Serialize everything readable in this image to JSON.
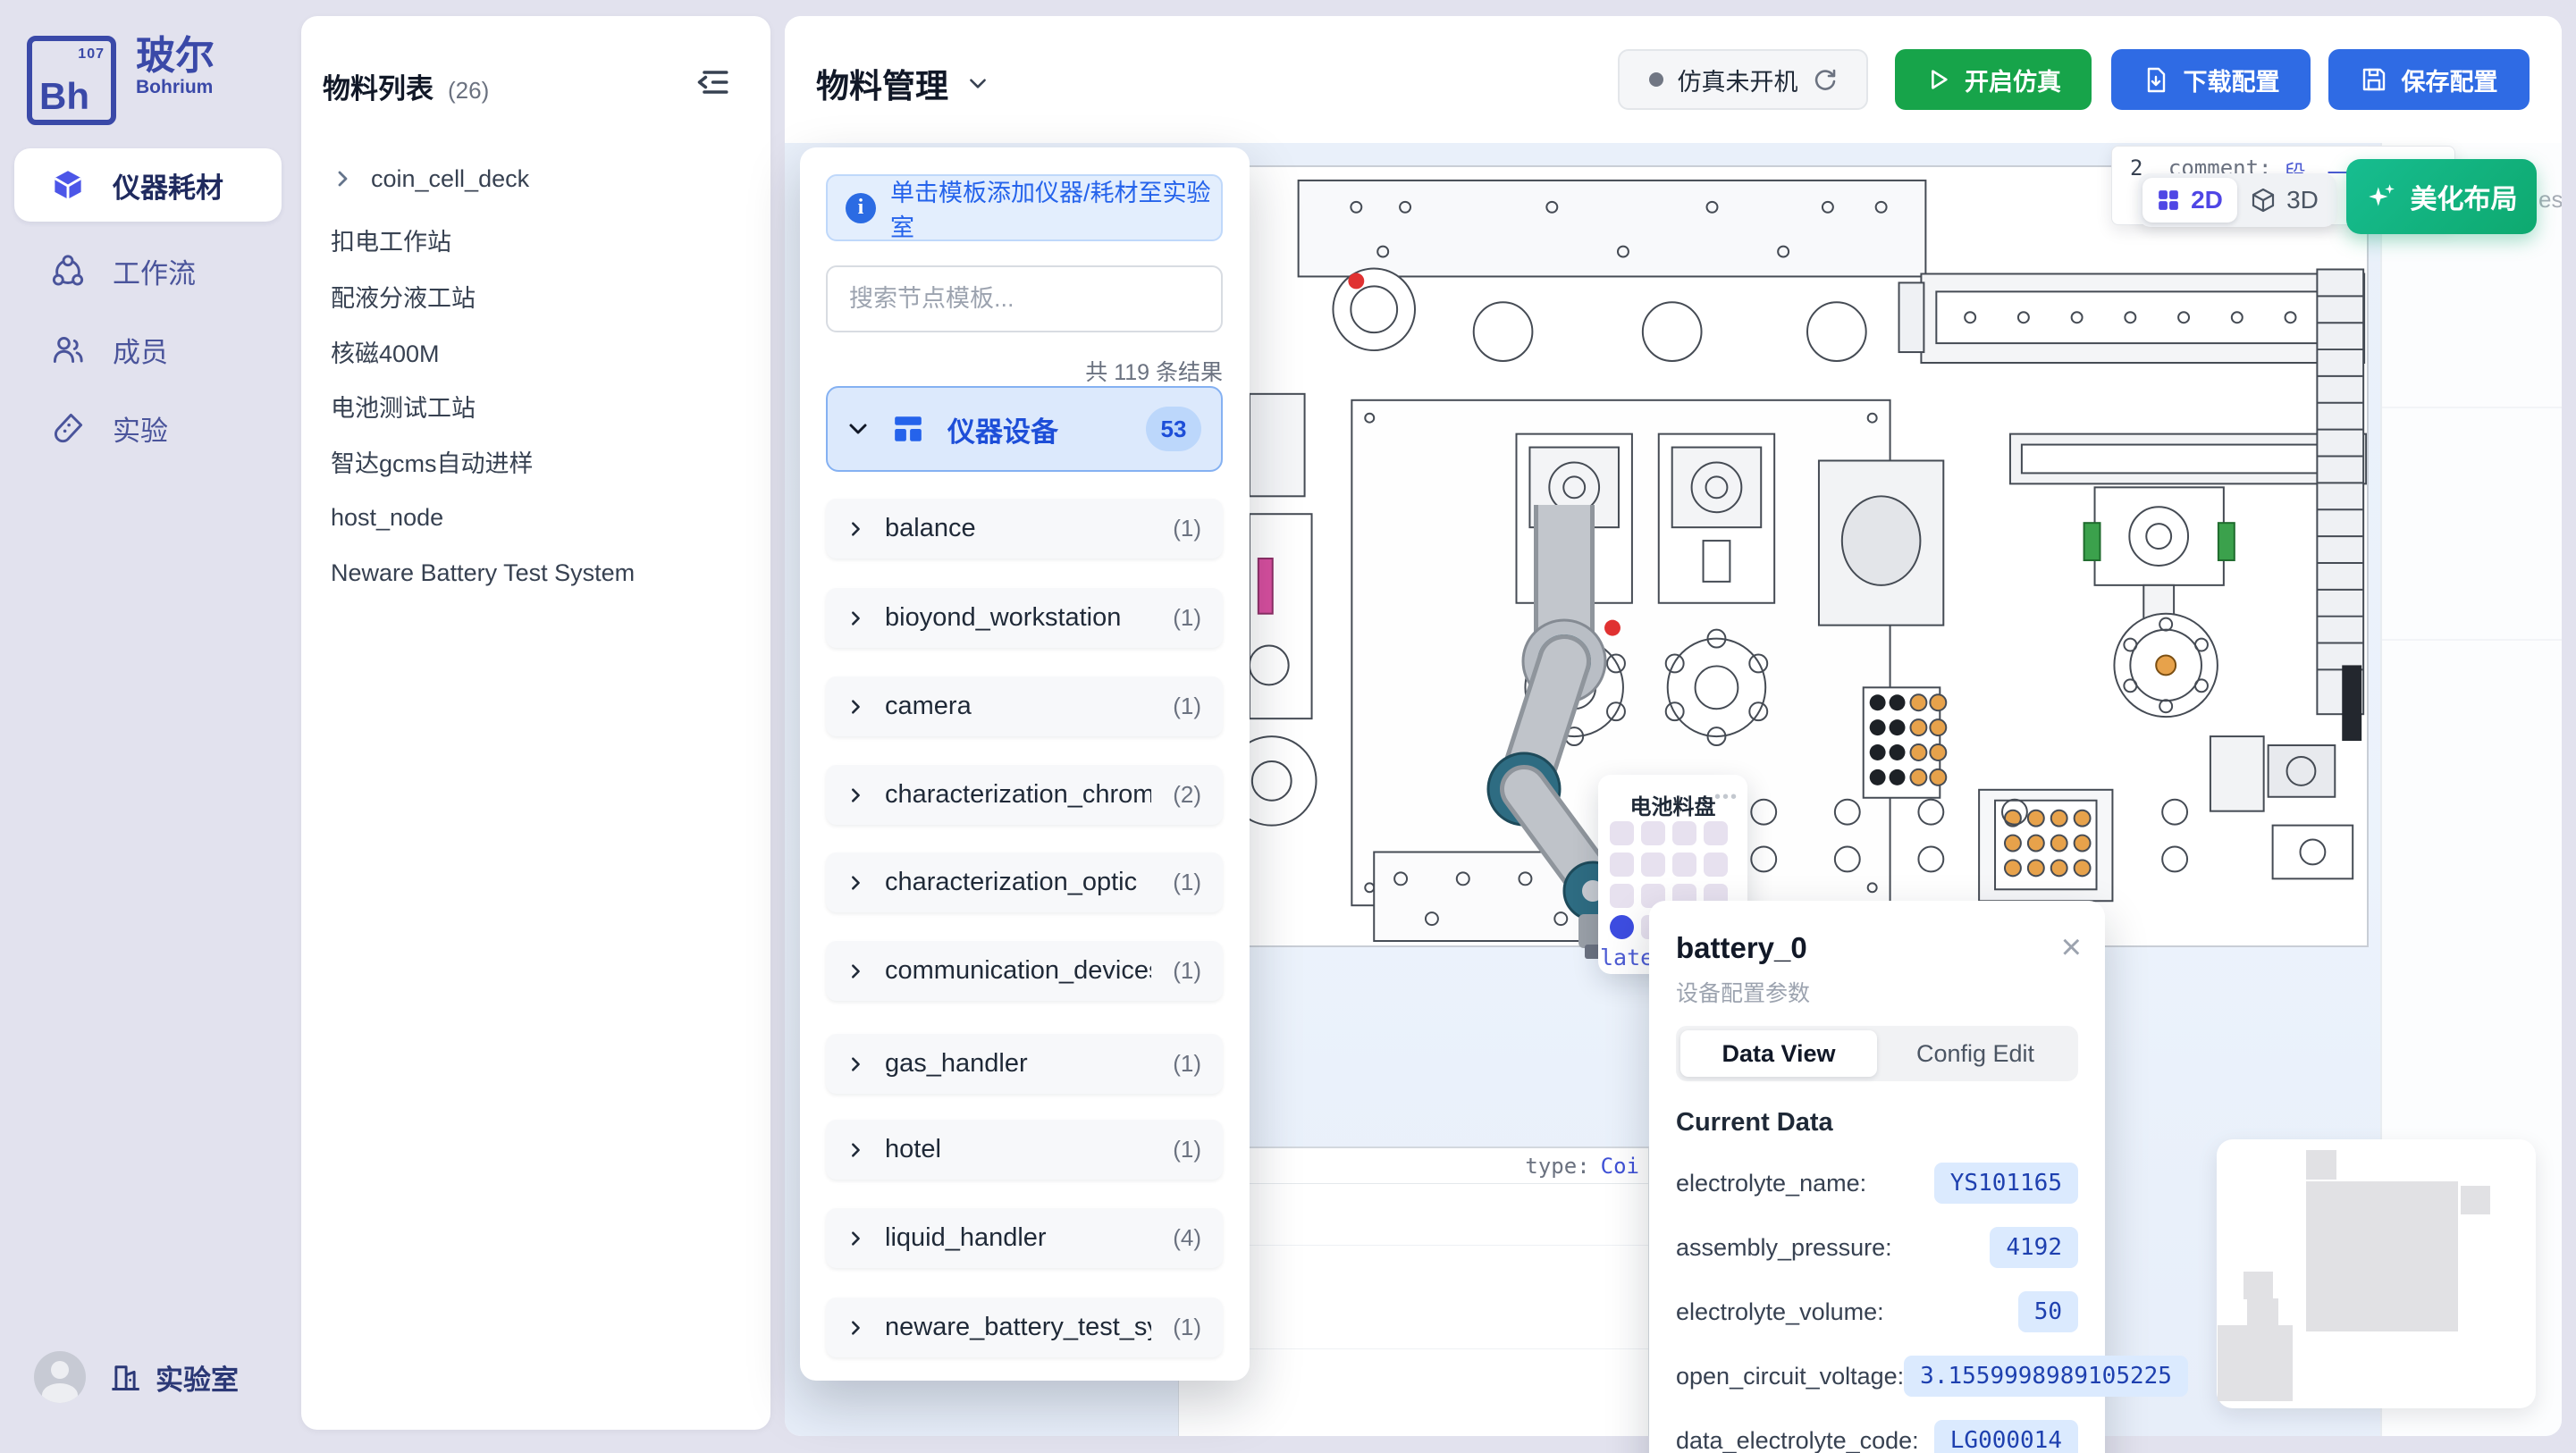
{
  "colors": {
    "brand_indigo": "#3A49A8",
    "accent_blue": "#2563EB",
    "button_blue": "#2F6BE4",
    "button_green": "#17A44A",
    "beautify_green": "#12B487",
    "selected_blue": "#3D4DE1",
    "value_text_blue": "#1E40AF",
    "value_pill_bg": "#DBEAFE",
    "canvas_blue": "#EAF1FB",
    "cad_magenta": "#D84F9F",
    "cad_orange": "#E7A24B"
  },
  "sidebar": {
    "logo": {
      "symbol": "Bh",
      "number": "107",
      "name_cn": "玻尔",
      "name_en": "Bohrium"
    },
    "items": [
      {
        "label": "仪器耗材",
        "icon": "cube-icon",
        "active": true
      },
      {
        "label": "工作流",
        "icon": "workflow-icon",
        "active": false
      },
      {
        "label": "成员",
        "icon": "members-icon",
        "active": false
      },
      {
        "label": "实验",
        "icon": "experiment-icon",
        "active": false
      }
    ],
    "footer": {
      "label": "实验室",
      "icon": "building-icon"
    }
  },
  "material_list": {
    "title": "物料列表",
    "count": "(26)",
    "items": [
      {
        "label": "coin_cell_deck",
        "expandable": true
      },
      {
        "label": "扣电工作站"
      },
      {
        "label": "配液分液工站"
      },
      {
        "label": "核磁400M"
      },
      {
        "label": "电池测试工站"
      },
      {
        "label": "智达gcms自动进样"
      },
      {
        "label": "host_node"
      },
      {
        "label": "Neware Battery Test System"
      }
    ]
  },
  "header": {
    "title": "物料管理",
    "status": {
      "label": "仿真未开机"
    },
    "buttons": {
      "start": "开启仿真",
      "download": "下载配置",
      "save": "保存配置"
    }
  },
  "template_panel": {
    "banner": "单击模板添加仪器/耗材至实验室",
    "search_placeholder": "搜索节点模板...",
    "result_count": "共 119 条结果",
    "category": {
      "label": "仪器设备",
      "count": "53"
    },
    "items": [
      {
        "label": "balance",
        "count": "(1)"
      },
      {
        "label": "bioyond_workstation",
        "count": "(1)"
      },
      {
        "label": "camera",
        "count": "(1)"
      },
      {
        "label": "characterization_chromatic",
        "count": "(2)"
      },
      {
        "label": "characterization_optic",
        "count": "(1)"
      },
      {
        "label": "communication_devices",
        "count": "(1)"
      },
      {
        "label": "gas_handler",
        "count": "(1)"
      },
      {
        "label": "hotel",
        "count": "(1)"
      },
      {
        "label": "liquid_handler",
        "count": "(4)"
      },
      {
        "label": "neware_battery_test_system",
        "count": "(1)"
      }
    ]
  },
  "canvas": {
    "toggle": {
      "d2": "2D",
      "d3": "3D"
    },
    "beautify": "美化布局",
    "comment_tooltip": {
      "prefix": "2",
      "label": "_comment:",
      "value": "段，一般为空，stat",
      "line2": "法化固定"
    },
    "resource_fragment": "esou",
    "type_tooltip": {
      "label": "type:",
      "value": "Coi"
    },
    "tray": {
      "title": "电池料盘",
      "fragment": "late"
    }
  },
  "detail_panel": {
    "title": "battery_0",
    "subtitle": "设备配置参数",
    "tabs": [
      {
        "label": "Data View",
        "active": true
      },
      {
        "label": "Config Edit",
        "active": false
      }
    ],
    "section": "Current Data",
    "fields": [
      {
        "label": "electrolyte_name:",
        "value": "YS101165"
      },
      {
        "label": "assembly_pressure:",
        "value": "4192"
      },
      {
        "label": "electrolyte_volume:",
        "value": "50"
      },
      {
        "label": "open_circuit_voltage:",
        "value": "3.1559998989105225"
      },
      {
        "label": "data_electrolyte_code:",
        "value": "LG000014"
      }
    ]
  }
}
